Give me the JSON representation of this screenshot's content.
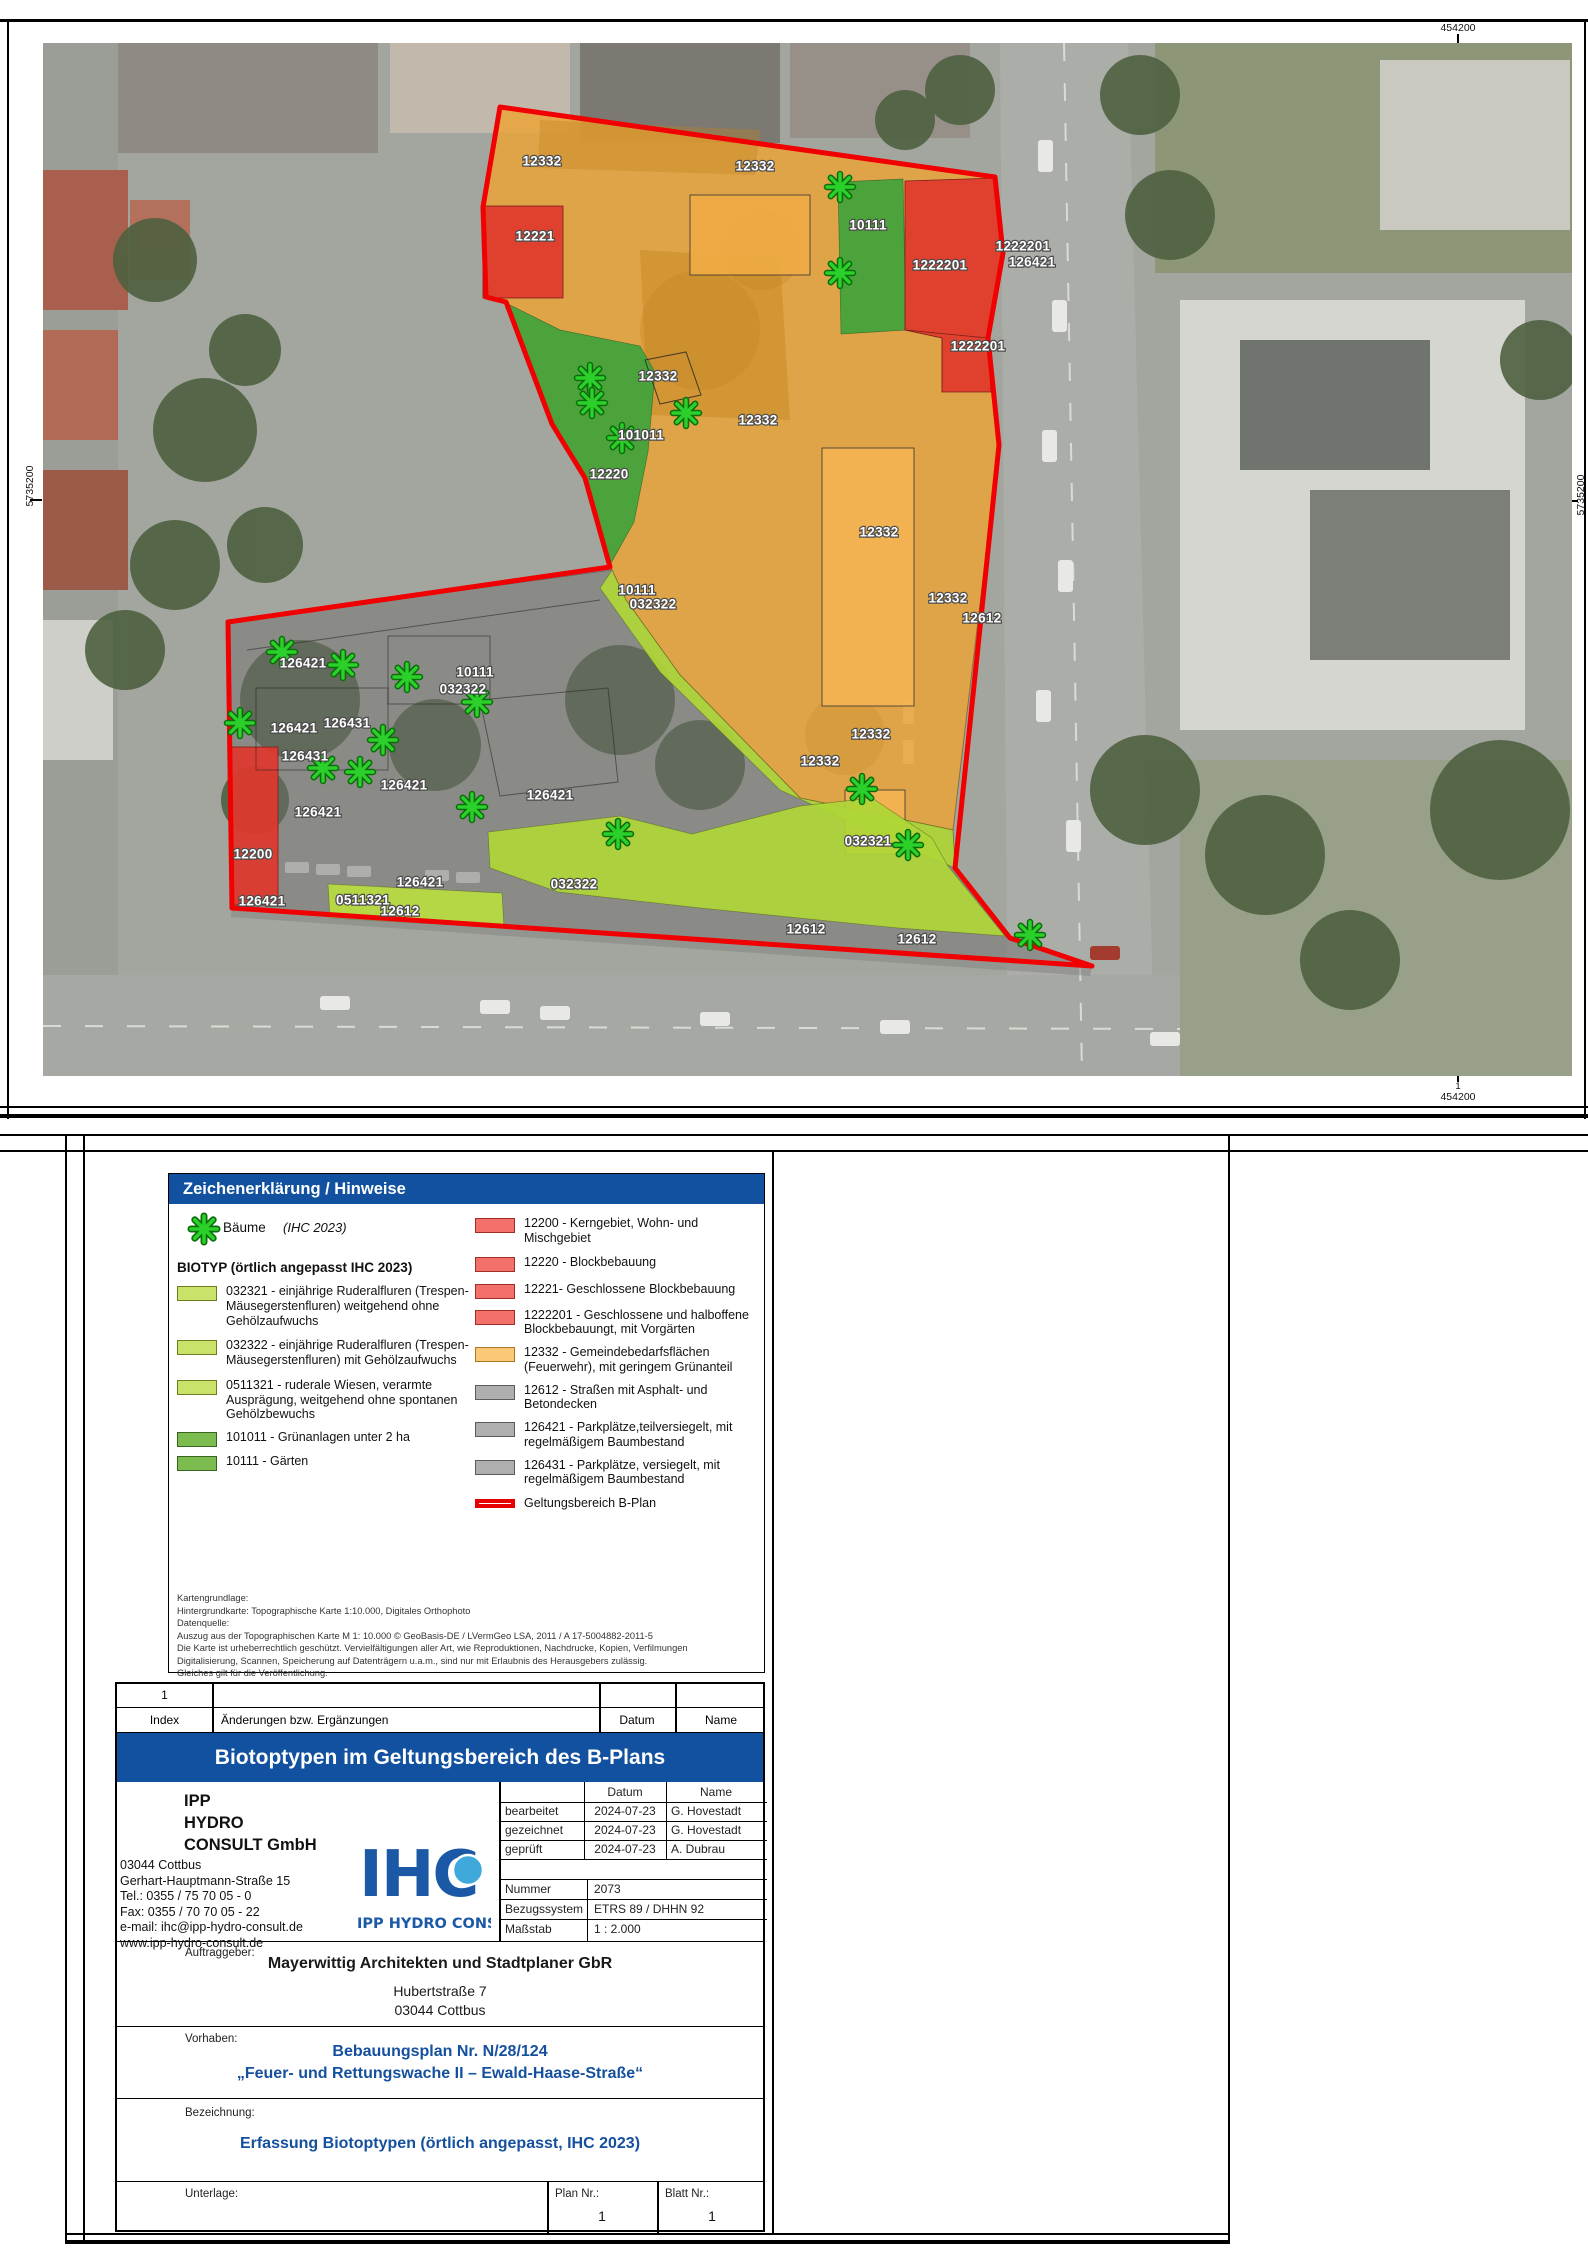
{
  "map": {
    "grid": {
      "top_label": "454200",
      "bottom_label": "454200",
      "bottom_index": "1",
      "left_label": "5735200",
      "right_label": "5735200"
    },
    "colors": {
      "orange": "#E8A43C",
      "red": "#DF372D",
      "green": "#3FA33C",
      "lightgreen": "#AFD637",
      "gray": "#787878",
      "boundary": "#F00000",
      "tree": "#2BD02B"
    },
    "area_labels": [
      {
        "t": "12332",
        "x": 542,
        "y": 162
      },
      {
        "t": "12332",
        "x": 755,
        "y": 167
      },
      {
        "t": "12221",
        "x": 535,
        "y": 237
      },
      {
        "t": "10111",
        "x": 868,
        "y": 226
      },
      {
        "t": "1222201",
        "x": 940,
        "y": 266
      },
      {
        "t": "1222201",
        "x": 1023,
        "y": 247
      },
      {
        "t": "126421",
        "x": 1032,
        "y": 263
      },
      {
        "t": "1222201",
        "x": 978,
        "y": 347
      },
      {
        "t": "12332",
        "x": 658,
        "y": 377
      },
      {
        "t": "12332",
        "x": 758,
        "y": 421
      },
      {
        "t": "101011",
        "x": 641,
        "y": 436
      },
      {
        "t": "12220",
        "x": 609,
        "y": 475
      },
      {
        "t": "12332",
        "x": 879,
        "y": 533
      },
      {
        "t": "12332",
        "x": 948,
        "y": 599
      },
      {
        "t": "12612",
        "x": 982,
        "y": 619
      },
      {
        "t": "10111",
        "x": 637,
        "y": 591
      },
      {
        "t": "032322",
        "x": 653,
        "y": 605
      },
      {
        "t": "126421",
        "x": 303,
        "y": 664
      },
      {
        "t": "10111",
        "x": 475,
        "y": 673
      },
      {
        "t": "032322",
        "x": 463,
        "y": 690
      },
      {
        "t": "126431",
        "x": 347,
        "y": 724
      },
      {
        "t": "126421",
        "x": 294,
        "y": 729
      },
      {
        "t": "12332",
        "x": 871,
        "y": 735
      },
      {
        "t": "126431",
        "x": 305,
        "y": 757
      },
      {
        "t": "126421",
        "x": 404,
        "y": 786
      },
      {
        "t": "12332",
        "x": 820,
        "y": 762
      },
      {
        "t": "126421",
        "x": 550,
        "y": 796
      },
      {
        "t": "126421",
        "x": 318,
        "y": 813
      },
      {
        "t": "032321",
        "x": 868,
        "y": 842
      },
      {
        "t": "12200",
        "x": 253,
        "y": 855
      },
      {
        "t": "126421",
        "x": 420,
        "y": 883
      },
      {
        "t": "032322",
        "x": 574,
        "y": 885
      },
      {
        "t": "126421",
        "x": 262,
        "y": 902
      },
      {
        "t": "0511321",
        "x": 363,
        "y": 901
      },
      {
        "t": "12612",
        "x": 400,
        "y": 912
      },
      {
        "t": "12612",
        "x": 806,
        "y": 930
      },
      {
        "t": "12612",
        "x": 917,
        "y": 940
      }
    ],
    "trees": [
      {
        "x": 840,
        "y": 187
      },
      {
        "x": 840,
        "y": 273
      },
      {
        "x": 590,
        "y": 378
      },
      {
        "x": 592,
        "y": 403
      },
      {
        "x": 622,
        "y": 438
      },
      {
        "x": 686,
        "y": 413
      },
      {
        "x": 282,
        "y": 652
      },
      {
        "x": 343,
        "y": 665
      },
      {
        "x": 407,
        "y": 677
      },
      {
        "x": 477,
        "y": 702
      },
      {
        "x": 240,
        "y": 723
      },
      {
        "x": 383,
        "y": 740
      },
      {
        "x": 323,
        "y": 768
      },
      {
        "x": 360,
        "y": 772
      },
      {
        "x": 472,
        "y": 807
      },
      {
        "x": 618,
        "y": 834
      },
      {
        "x": 862,
        "y": 789
      },
      {
        "x": 908,
        "y": 845
      },
      {
        "x": 1030,
        "y": 935
      }
    ]
  },
  "legend": {
    "header": "Zeichenerklärung / Hinweise",
    "tree_label": "Bäume",
    "tree_note": "(IHC 2023)",
    "biotype_heading": "BIOTYP (örtlich angepasst IHC 2023)",
    "left_items": [
      {
        "swatch": "lightgreen",
        "text": "032321 - einjährige Ruderalfluren (Trespen-Mäusegerstenfluren) weitgehend ohne Gehölzaufwuchs"
      },
      {
        "swatch": "lightgreen",
        "text": "032322 - einjährige Ruderalfluren (Trespen-Mäusegerstenfluren) mit Gehölzaufwuchs"
      },
      {
        "swatch": "lightgreen",
        "text": "0511321 - ruderale Wiesen, verarmte Ausprägung, weitgehend ohne spontanen Gehölzbewuchs"
      },
      {
        "swatch": "green",
        "text": "101011 - Grünanlagen unter 2 ha"
      },
      {
        "swatch": "green",
        "text": "10111 - Gärten"
      }
    ],
    "right_items": [
      {
        "swatch": "red",
        "text": "12200 - Kerngebiet, Wohn- und Mischgebiet"
      },
      {
        "swatch": "red",
        "text": "12220 - Blockbebauung"
      },
      {
        "swatch": "red",
        "text": "12221- Geschlossene Blockbebauung"
      },
      {
        "swatch": "red",
        "text": "1222201 - Geschlossene und halboffene Blockbebauungt, mit Vorgärten"
      },
      {
        "swatch": "orange",
        "text": "12332 - Gemeindebedarfsflächen (Feuerwehr), mit geringem Grünanteil"
      },
      {
        "swatch": "gray",
        "text": "12612 - Straßen mit Asphalt- und Betondecken"
      },
      {
        "swatch": "gray",
        "text": "126421 - Parkplätze,teilversiegelt, mit regelmäßigem Baumbestand"
      },
      {
        "swatch": "gray",
        "text": "126431 - Parkplätze, versiegelt, mit regelmäßigem Baumbestand"
      },
      {
        "swatch": "boundary",
        "text": "Geltungsbereich B-Plan"
      }
    ],
    "source_lines": [
      "Kartengrundlage:",
      "Hintergrundkarte: Topographische Karte 1:10.000, Digitales Orthophoto",
      "Datenquelle:",
      "Auszug aus der Topographischen Karte M 1: 10.000 © GeoBasis-DE / LVermGeo LSA, 2011 / A 17-5004882-2011-5",
      "Die Karte ist urheberrechtlich geschützt. Vervielfältigungen aller Art, wie Reproduktionen, Nachdrucke, Kopien, Verfilmungen",
      "Digitalisierung, Scannen, Speicherung auf Datenträgern u.a.m., sind nur mit Erlaubnis des Herausgebers zulässig.",
      "Gleiches gilt für die Veröffentlichung."
    ]
  },
  "index_table": {
    "row1_index": "1",
    "col_index": "Index",
    "col_changes": "Änderungen bzw. Ergänzungen",
    "col_date": "Datum",
    "col_name": "Name"
  },
  "title_bar": {
    "text": "Biotoptypen im Geltungsbereich des B-Plans"
  },
  "company": {
    "name_line1": "IPP",
    "name_line2": "HYDRO",
    "name_line3": "CONSULT GmbH",
    "address_lines": [
      "03044 Cottbus",
      "Gerhart-Hauptmann-Straße 15",
      "Tel.:  0355 / 75 70 05 - 0",
      "Fax:  0355 / 70 70 05 - 22",
      "e-mail: ihc@ipp-hydro-consult.de",
      "www.ipp-hydro-consult.de"
    ],
    "logo_text": "IHC",
    "logo_subtext": "IPP HYDRO CONSULT"
  },
  "approval": {
    "col_date": "Datum",
    "col_name": "Name",
    "rows": [
      {
        "label": "bearbeitet",
        "date": "2024-07-23",
        "name": "G. Hovestadt"
      },
      {
        "label": "gezeichnet",
        "date": "2024-07-23",
        "name": "G. Hovestadt"
      },
      {
        "label": "geprüft",
        "date": "2024-07-23",
        "name": "A. Dubrau"
      }
    ],
    "meta_rows": [
      {
        "label": "Nummer",
        "value": "2073"
      },
      {
        "label": "Bezugssystem",
        "value": "ETRS 89 / DHHN 92"
      },
      {
        "label": "Maßstab",
        "value": "1 : 2.000"
      }
    ]
  },
  "client": {
    "label": "Auftraggeber:",
    "name": "Mayerwittig Architekten und Stadtplaner GbR",
    "street": "Hubertstraße 7",
    "city": "03044 Cottbus"
  },
  "project": {
    "label": "Vorhaben:",
    "line1": "Bebauungsplan Nr. N/28/124",
    "line2": "„Feuer- und Rettungswache II – Ewald-Haase-Straße“"
  },
  "description": {
    "label": "Bezeichnung:",
    "text": "Erfassung Biotoptypen (örtlich angepasst, IHC 2023)"
  },
  "footer": {
    "doc_label": "Unterlage:",
    "plan_label": "Plan Nr.:",
    "plan_value": "1",
    "sheet_label": "Blatt Nr.:",
    "sheet_value": "1"
  }
}
